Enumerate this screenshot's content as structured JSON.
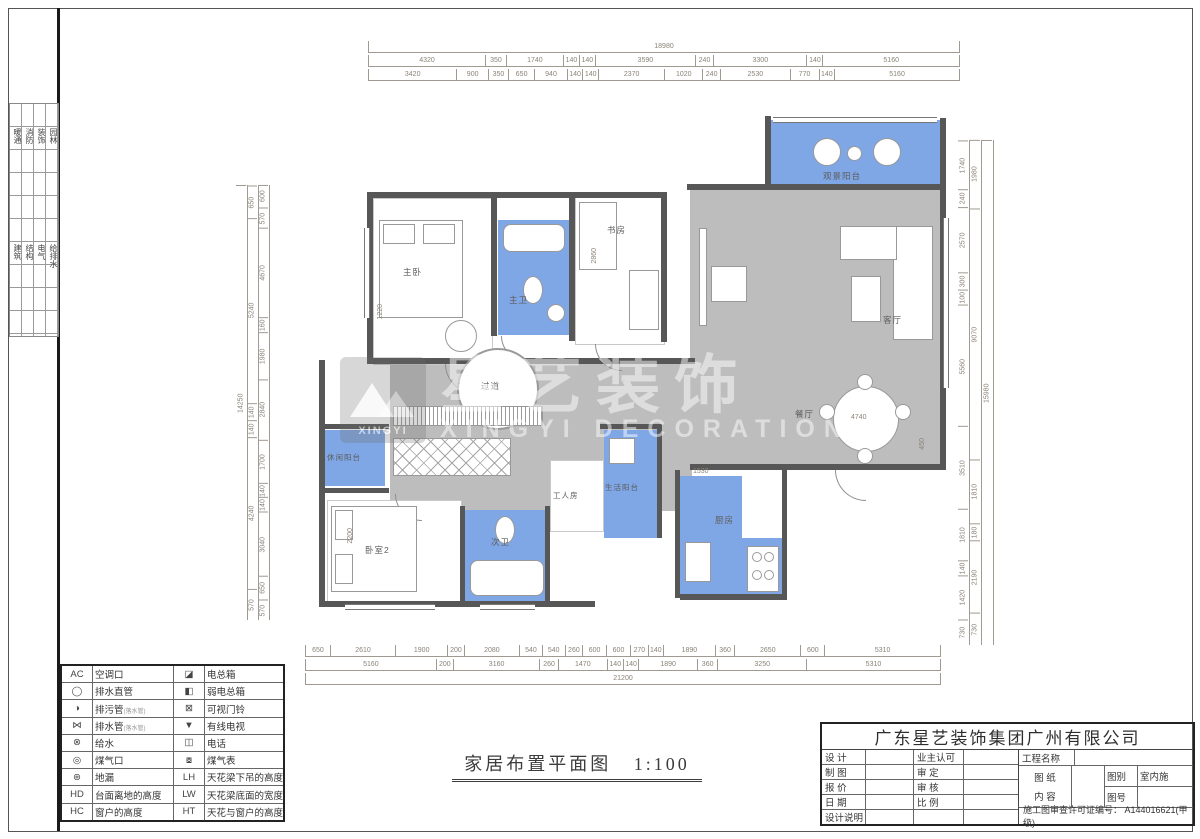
{
  "sheet": {
    "title": "家居布置平面图",
    "scale": "1:100"
  },
  "watermark": {
    "brand_cn": "星艺装饰",
    "brand_en": "XINGYI DECORATION",
    "logo_text": "XINGYI"
  },
  "side_tabs": {
    "group1": [
      "暖通",
      "消防",
      "装饰",
      "园林"
    ],
    "group2": [
      "建筑",
      "结构",
      "电气",
      "给排水"
    ]
  },
  "dims": {
    "top": {
      "total": "18980",
      "row2": [
        "4320",
        "350",
        "1740",
        "140",
        "140",
        "3590",
        "240",
        "3300",
        "140",
        "5160"
      ],
      "row3": [
        "3420",
        "900",
        "350",
        "650",
        "940",
        "140",
        "140",
        "2370",
        "1020",
        "240",
        "2530",
        "770",
        "140",
        "5160"
      ]
    },
    "bottom": {
      "row1": [
        "650",
        "2610",
        "1900",
        "200",
        "2080",
        "540",
        "540",
        "260",
        "600",
        "600",
        "270",
        "140",
        "1890",
        "360",
        "2650",
        "600",
        "5310"
      ],
      "row2": [
        "5160",
        "200",
        "3160",
        "260",
        "1470",
        "140",
        "140",
        "1890",
        "360",
        "3250",
        "5310"
      ],
      "total": "21200"
    },
    "left": {
      "total": "14250",
      "outer": [
        "650",
        "5240",
        "140",
        "140",
        "4240",
        "570"
      ],
      "inner": [
        "600",
        "570",
        "4670",
        "160",
        "1980",
        "2840",
        "1700",
        "140",
        "140",
        "3040",
        "650",
        "570"
      ]
    },
    "right": {
      "total": "15980",
      "outer": [
        "1980",
        "9070",
        "1810",
        "180",
        "2190",
        "730"
      ],
      "inner": [
        "1740",
        "240",
        "2570",
        "300",
        "100",
        "5560",
        "3510",
        "1810",
        "140",
        "1420",
        "730"
      ]
    }
  },
  "plan": {
    "rooms": [
      {
        "label": "主卧"
      },
      {
        "label": "主卫"
      },
      {
        "label": "书房"
      },
      {
        "label": "过道"
      },
      {
        "label": "客厅"
      },
      {
        "label": "餐厅"
      },
      {
        "label": "观景阳台"
      },
      {
        "label": "休闲阳台"
      },
      {
        "label": "卧室2"
      },
      {
        "label": "次卫"
      },
      {
        "label": "工人房"
      },
      {
        "label": "生活阳台"
      },
      {
        "label": "厨房"
      }
    ],
    "interior_dims": [
      "2860",
      "1530",
      "4740",
      "2200",
      "450",
      "1220"
    ]
  },
  "legend": {
    "rows": [
      {
        "s1": "AC",
        "l1": "空调口",
        "sub1": "",
        "s2": "◪",
        "l2": "电总箱"
      },
      {
        "s1": "◯",
        "l1": "排水直管",
        "sub1": "",
        "s2": "◧",
        "l2": "弱电总箱"
      },
      {
        "s1": "◑",
        "l1": "排污管",
        "sub1": "(落水管)",
        "s2": "⊠",
        "l2": "可视门铃"
      },
      {
        "s1": "⋈",
        "l1": "排水管",
        "sub1": "(落水管)",
        "s2": "▼",
        "l2": "有线电视"
      },
      {
        "s1": "⊗",
        "l1": "给水",
        "sub1": "",
        "s2": "◫",
        "l2": "电话"
      },
      {
        "s1": "◎",
        "l1": "煤气口",
        "sub1": "",
        "s2": "⧇",
        "l2": "煤气表"
      },
      {
        "s1": "⊛",
        "l1": "地漏",
        "sub1": "",
        "s2": "LH",
        "l2": "天花梁下吊的高度"
      },
      {
        "s1": "HD",
        "l1": "台面离地的高度",
        "sub1": "",
        "s2": "LW",
        "l2": "天花梁底面的宽度"
      },
      {
        "s1": "HC",
        "l1": "窗户的高度",
        "sub1": "",
        "s2": "HT",
        "l2": "天花与窗户的高度"
      }
    ]
  },
  "titleblock": {
    "company": "广东星艺装饰集团广州有限公司",
    "left": [
      "设 计",
      "制 图",
      "报 价",
      "日 期",
      "设计说明"
    ],
    "mid": [
      "业主认可",
      "审 定",
      "审 核",
      "比 例",
      ""
    ],
    "project_label": "工程名称",
    "sheet_label_1": "图 纸",
    "sheet_label_2": "内 容",
    "type_label": "图别",
    "type_value": "室内施",
    "no_label": "图号",
    "permit": "施工图审查许可证编号：  A144016621(甲级)"
  }
}
